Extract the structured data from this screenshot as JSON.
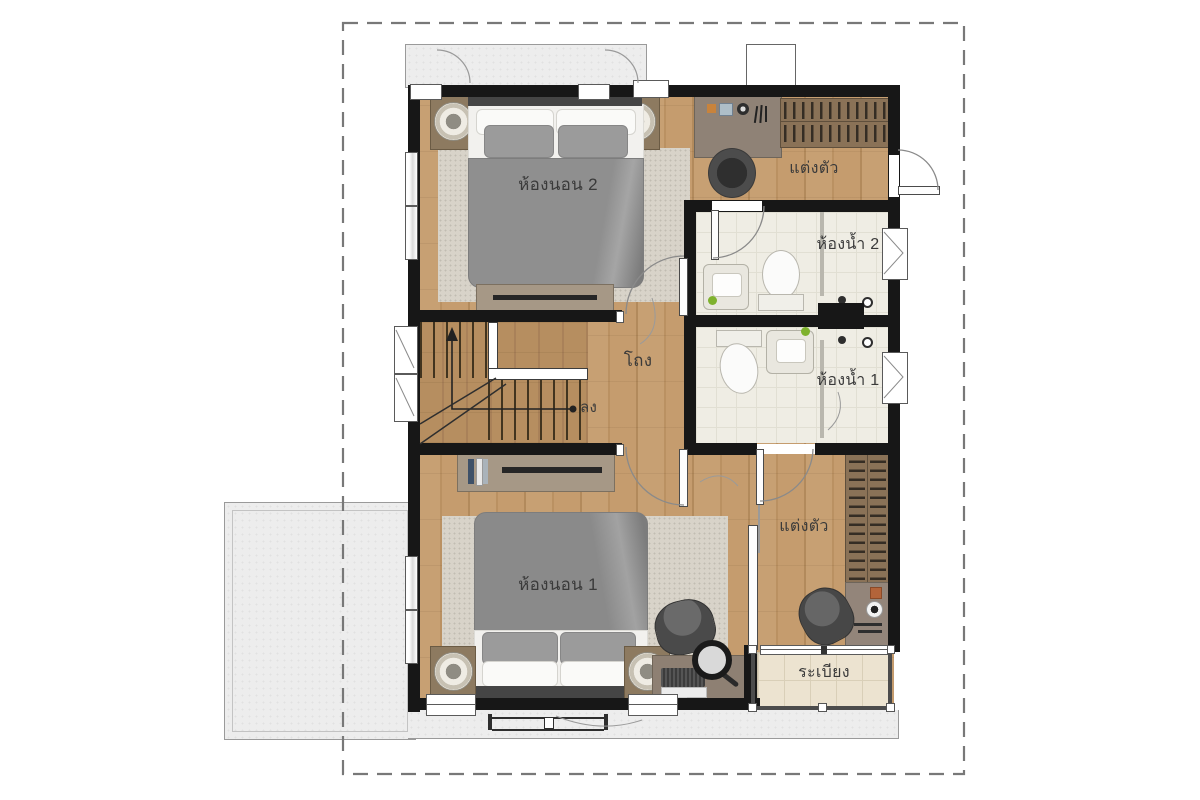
{
  "rooms": [
    {
      "id": "bedroom-2",
      "label": "ห้องนอน 2"
    },
    {
      "id": "dressing-top",
      "label": "แต่งตัว"
    },
    {
      "id": "bathroom-2",
      "label": "ห้องน้ำ 2"
    },
    {
      "id": "hall",
      "label": "โถง"
    },
    {
      "id": "stairs-down",
      "label": "ลง"
    },
    {
      "id": "bathroom-1",
      "label": "ห้องน้ำ 1"
    },
    {
      "id": "dressing-bottom",
      "label": "แต่งตัว"
    },
    {
      "id": "bedroom-1",
      "label": "ห้องนอน 1"
    },
    {
      "id": "balcony",
      "label": "ระเบียง"
    }
  ],
  "colors": {
    "wall": "#171717",
    "wood_floor": "#c29a6c",
    "stair_wood": "#b28a5c",
    "bathroom_tile": "#efede4",
    "balcony_tile": "#ece3d0",
    "concrete": "#ededed",
    "boundary_dash": "#787878",
    "bed_blanket": "#909090",
    "rug": "#d8d3c9",
    "furniture_wood": "#8a7257",
    "cabinet_wood": "#a69886",
    "label_text": "#3a3a3a",
    "accent_green": "#7fb22e"
  },
  "icons": {
    "beds": "double-bed-icon",
    "lamps": "bedside-ring-lamp-icon",
    "tv": "tv-console-icon",
    "wardrobe": "wardrobe-hangers-icon",
    "toilet": "toilet-icon",
    "sink": "sink-icon",
    "stairs": "staircase-icon",
    "laptop": "laptop-icon",
    "mirror": "hand-mirror-icon"
  }
}
